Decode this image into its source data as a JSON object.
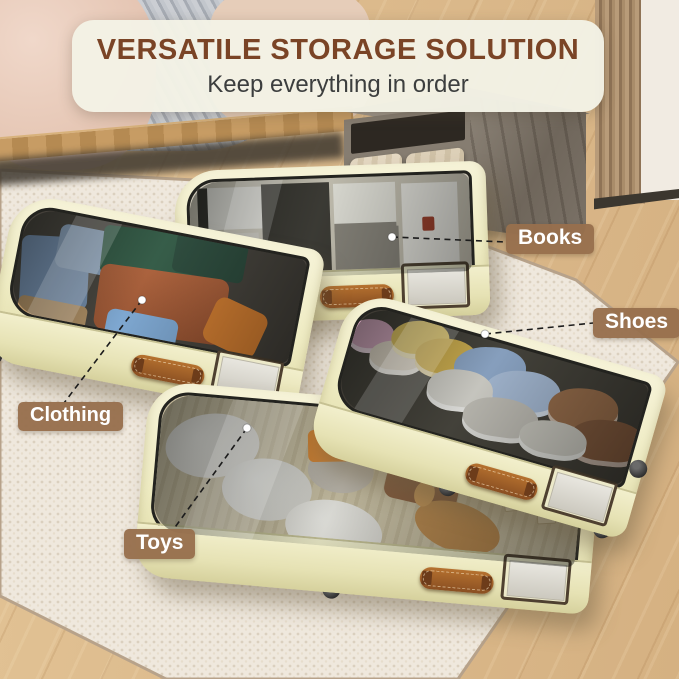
{
  "banner": {
    "title": "VERSATILE STORAGE SOLUTION",
    "subtitle": "Keep everything in order"
  },
  "callouts": [
    {
      "id": "books",
      "label": "Books"
    },
    {
      "id": "shoes",
      "label": "Shoes"
    },
    {
      "id": "clothing",
      "label": "Clothing"
    },
    {
      "id": "toys",
      "label": "Toys"
    }
  ],
  "scene": {
    "description": "Four cream under-bed rolling storage drawers with clear tops on a white boucle rug; bed at top-left, wooden nightstand and slat wall at top-right, wooden floor",
    "drawers": [
      {
        "name": "clothing-drawer",
        "contents": "folded clothes"
      },
      {
        "name": "books-drawer",
        "contents": "books and magazines"
      },
      {
        "name": "shoes-drawer",
        "contents": "sneakers"
      },
      {
        "name": "toys-drawer",
        "contents": "plush toys, truck and letter blocks"
      }
    ]
  },
  "colors": {
    "banner_bg": "#f3f2e5",
    "title_text": "#7a4426",
    "subtitle_text": "#3c3e3e",
    "callout_bg": "#976f4d",
    "callout_text": "#ffffff",
    "drawer_shell": "#efecc3",
    "handle_leather": "#9a5f2c",
    "rug": "#efe8dd",
    "wood_floor": "#dcba8c",
    "leader_line": "#1c1c1c"
  }
}
